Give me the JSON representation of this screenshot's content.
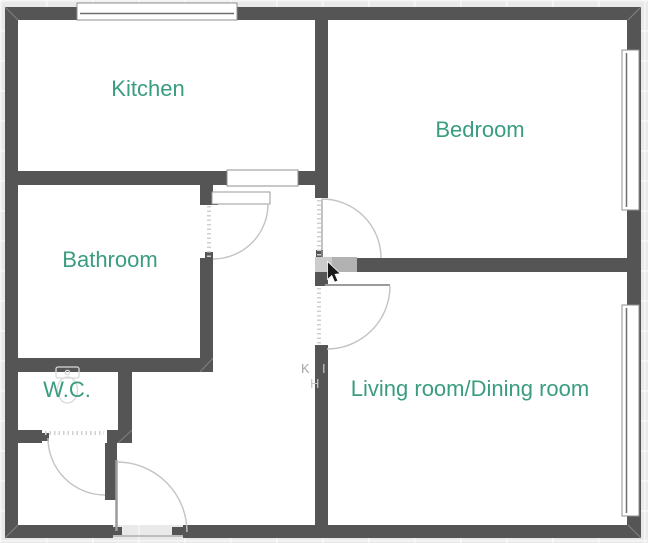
{
  "rooms": {
    "kitchen": {
      "label": "Kitchen"
    },
    "bedroom": {
      "label": "Bedroom"
    },
    "bathroom": {
      "label": "Bathroom"
    },
    "wc": {
      "label": "W.C."
    },
    "living_dining": {
      "label": "Living room/Dining room"
    }
  },
  "watermark": {
    "k": "K",
    "i": "I",
    "h": "H"
  },
  "colors": {
    "wall": "#555555",
    "floor": "#ffffff",
    "background": "#e9e9e9",
    "room_label": "#3a9c81",
    "door_arc": "#c3c3c3",
    "door_leaf": "#9b9b9b",
    "window_border": "#8f8f8f",
    "window_line": "#6f6f6f",
    "selected_wall": "#b2b2b2",
    "selected_wall_light": "#cccccc",
    "fixture_outline": "#d9d9d9",
    "watermark_text": "#a5a5a5",
    "cursor": "#1a1a1a",
    "corner_miter": "#8d8d8d"
  }
}
